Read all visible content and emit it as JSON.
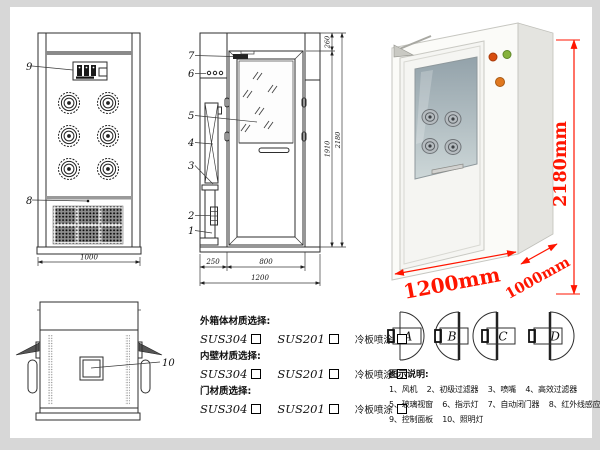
{
  "front_view": {
    "label_9": "9",
    "label_8": "8",
    "dim_width": "1000"
  },
  "side_view": {
    "label_7": "7",
    "label_6": "6",
    "label_5": "5",
    "label_4": "4",
    "label_3": "3",
    "label_2": "2",
    "label_1": "1",
    "dim_top": "260",
    "dim_door_height": "1910",
    "dim_total_height": "2180",
    "dim_side": "250",
    "dim_door_width": "800",
    "dim_total_width": "1200"
  },
  "top_view": {
    "label_10": "10"
  },
  "photo": {
    "dim_height": "2180mm",
    "dim_width": "1200mm",
    "dim_depth": "1000mm",
    "dim_color": "#ff1500"
  },
  "materials": {
    "sections": [
      {
        "title": "外箱体材质选择:",
        "opt1": "SUS304",
        "opt2": "SUS201",
        "opt3": "冷板喷涂"
      },
      {
        "title": "内壁材质选择:",
        "opt1": "SUS304",
        "opt2": "SUS201",
        "opt3": "冷板喷涂"
      },
      {
        "title": "门材质选择:",
        "opt1": "SUS304",
        "opt2": "SUS201",
        "opt3": "冷板喷涂"
      }
    ]
  },
  "door_options": {
    "a": "A",
    "b": "B",
    "c": "C",
    "d": "D"
  },
  "legend": {
    "title": "图示说明:",
    "items": [
      "1、风机",
      "2、初级过滤器",
      "3、喷嘴",
      "4、高效过滤器",
      "5、玻璃视窗",
      "6、指示灯",
      "7、自动闭门器",
      "8、红外线感应器",
      "9、控制面板",
      "10、照明灯"
    ]
  }
}
